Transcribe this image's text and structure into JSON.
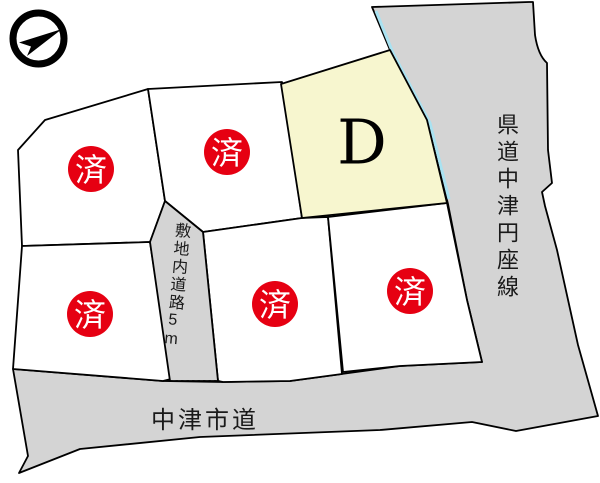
{
  "map": {
    "compass": {
      "icon": "north-arrow",
      "direction": "up-right"
    },
    "roads": {
      "prefectural_label": "県道中津円座線",
      "city_label": "中津市道",
      "internal_label": "敷地内道路5m"
    },
    "lots": {
      "available": {
        "id": "D",
        "label": "D",
        "status": "available"
      },
      "sold_label": "済",
      "sold_count": 5
    },
    "colors": {
      "road_fill": "#d4d4d4",
      "available_fill": "#f7f6cf",
      "lot_fill": "#ffffff",
      "sold_badge_fill": "#e60012",
      "waterline": "#a9e2f1",
      "outline": "#000000"
    }
  }
}
